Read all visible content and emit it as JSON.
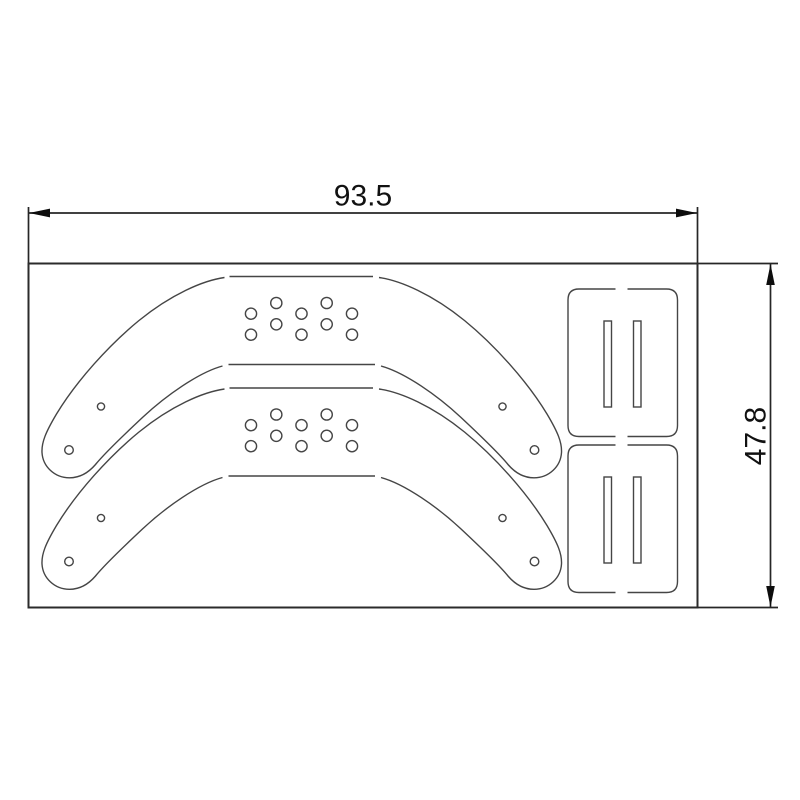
{
  "drawing": {
    "width_label": "93.5",
    "height_label": "47.8",
    "sheet_line_color": "#2b2b2b",
    "dim_line_color": "#262626",
    "part_line_color": "#454545",
    "arrow_color": "#0d0d0d",
    "background": "#ffffff"
  },
  "parts": {
    "curved_bracket_count": 2,
    "slotted_plate_count": 2,
    "slots_per_plate": 2,
    "grid_holes_per_bracket": 10,
    "end_holes_per_bracket": 4
  },
  "geometry": {
    "bracket_hole_columns_x": [
      251,
      276.3,
      301.5,
      326.7,
      352
    ],
    "bracket_hole_rows_y_even": [
      313.7,
      334.7
    ],
    "bracket_hole_rows_y_odd": [
      303,
      324.3
    ],
    "bracket_hole_radius": 5.6,
    "bracket_tip_holes": [
      [
        69,
        450
      ],
      [
        534.5,
        450
      ]
    ],
    "bracket_tip_hole_radius": 4.3,
    "bracket_small_holes": [
      [
        101,
        406.5
      ],
      [
        502.5,
        406.5
      ]
    ],
    "bracket_small_hole_radius": 3.6
  }
}
